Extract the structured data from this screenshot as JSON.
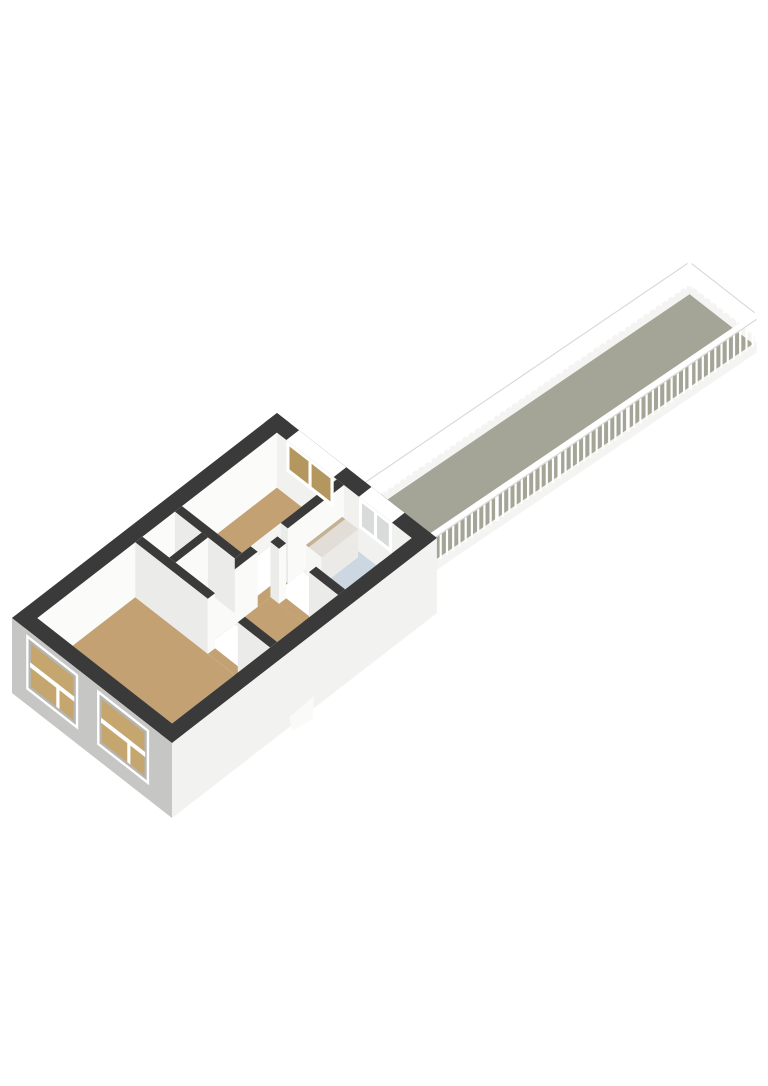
{
  "scene": {
    "background": "#ffffff",
    "projection": {
      "origin": [
        12,
        673
      ],
      "axisA": [
        0.791,
        -0.612
      ],
      "axisB": [
        0.788,
        0.616
      ],
      "balconyAxis": [
        0.78,
        -0.53
      ],
      "balconyStartA": 335
    },
    "colors": {
      "wallTop": "#3a3a3a",
      "faceSW": "#ebebe9",
      "faceSE": "#fafaf9",
      "innerNW": "#fbfbfa",
      "innerNE": "#f1f1ef",
      "skirtSW": "#eeeeec",
      "skirtSE": "#f4f4f2",
      "floorTan": "#c3a172",
      "floorBath": "#ccd7e1",
      "floorCloset": "#e3e2e0",
      "floorBalcony": "#a4a597",
      "doormat": "#fbfbfa",
      "facadeSW": "#c6c6c5",
      "facadeSE": "#f2f2f0",
      "reveal": "#b5b5b3",
      "facadePane": "#c4a66e",
      "tanPane": "#b3975f",
      "grayPane": "#d8dbda",
      "railWhite": "#ffffff",
      "railLight": "#f4f4f2",
      "railShadow": "#d9d9d7",
      "frameWhite": "#ffffff",
      "vanityTop": "#e2ded7",
      "vanityFront": "#f6f6f4",
      "vanitySide": "#eceae6",
      "vanityRim": "#c5b193"
    },
    "apartment": {
      "plan": {
        "length": 335,
        "width": 203,
        "extWall": 16,
        "innerA": 319,
        "innerB": 187,
        "wallHeight": 55,
        "skirt": 40,
        "facadeDepth": 20
      },
      "rooms": [
        {
          "name": "living-room-floor",
          "floor": "floorTan",
          "a": [
            16,
            140
          ],
          "b": [
            16,
            187
          ]
        },
        {
          "name": "closet-1-floor",
          "floor": "floorCloset",
          "a": [
            149,
            190
          ],
          "b": [
            16,
            50
          ]
        },
        {
          "name": "closet-2-floor",
          "floor": "floorCloset",
          "a": [
            149,
            190
          ],
          "b": [
            58,
            92
          ]
        },
        {
          "name": "bedroom-floor",
          "floor": "floorTan",
          "a": [
            199,
            319
          ],
          "b": [
            16,
            92
          ]
        },
        {
          "name": "hallway-floor",
          "floor": "floorTan",
          "a": [
            149,
            226
          ],
          "b": [
            101,
            187
          ]
        },
        {
          "name": "bathroom-floor",
          "floor": "floorBath",
          "a": [
            235,
            319
          ],
          "b": [
            101,
            187
          ]
        }
      ],
      "doorGaps": [
        {
          "name": "living-room-door-opening",
          "a": [
            140,
            149
          ],
          "b": [
            108,
            146
          ]
        },
        {
          "name": "bedroom-door-opening",
          "a": [
            210,
            248
          ],
          "b": [
            92,
            101
          ]
        },
        {
          "name": "bathroom-door-opening",
          "a": [
            226,
            235
          ],
          "b": [
            112,
            150
          ]
        }
      ],
      "wallsBack": [
        {
          "name": "wall-bedroom-hallway-left",
          "a": [
            149,
            210
          ],
          "b": [
            92,
            101
          ],
          "face": "se"
        },
        {
          "name": "wall-bedroom-hallway-right",
          "a": [
            248,
            319
          ],
          "b": [
            92,
            101
          ],
          "face": "se",
          "jamb": "sw"
        }
      ],
      "wallsFront": [
        {
          "name": "wall-bathroom-hallway-upper",
          "a": [
            226,
            235
          ],
          "b": [
            101,
            112
          ],
          "face": "sw",
          "jamb": "se"
        },
        {
          "name": "wall-bathroom-hallway-lower",
          "a": [
            226,
            235
          ],
          "b": [
            150,
            187
          ],
          "face": "sw"
        },
        {
          "name": "wall-closet-bedroom",
          "a": [
            190,
            199
          ],
          "b": [
            16,
            92
          ],
          "face": "sw"
        },
        {
          "name": "wall-closet-divider",
          "a": [
            149,
            190
          ],
          "b": [
            50,
            58
          ],
          "face": "se"
        },
        {
          "name": "wall-living-room-upper",
          "a": [
            140,
            149
          ],
          "b": [
            16,
            108
          ],
          "face": "sw",
          "jamb": "se"
        },
        {
          "name": "wall-living-room-lower",
          "a": [
            140,
            149
          ],
          "b": [
            146,
            187
          ],
          "face": "sw"
        }
      ],
      "neWindows": [
        {
          "name": "bedroom-window",
          "b": [
            28,
            88
          ],
          "pane": "tanPane"
        },
        {
          "name": "bathroom-window",
          "b": [
            120,
            162
          ],
          "pane": "grayPane"
        }
      ],
      "swWindows": [
        {
          "name": "facade-window-1",
          "b": [
            18,
            84
          ]
        },
        {
          "name": "facade-window-2",
          "b": [
            108,
            174
          ]
        }
      ],
      "vanity": {
        "a": [
          268,
          314
        ],
        "b": [
          104,
          124
        ],
        "h": 28
      },
      "doormat": {
        "a": [
          150,
          184
        ],
        "b": [
          168,
          187
        ]
      },
      "doorstep": {
        "a": [
          148,
          182
        ]
      }
    },
    "balcony": {
      "a": [
        335,
        760
      ],
      "b": [
        103,
        188
      ],
      "floorZ": 16,
      "railing": {
        "balusterStep": 8,
        "balusterW": 2.2,
        "postEvery": 85,
        "postW": 3.6,
        "far": {
          "baseZ": [
            12,
            22
          ],
          "balZ": [
            20,
            45
          ],
          "railZ": [
            45,
            51
          ]
        },
        "near": {
          "baseZ": [
            6,
            17
          ],
          "balZ": [
            14,
            40
          ],
          "railZ": [
            40,
            47
          ]
        }
      }
    }
  }
}
